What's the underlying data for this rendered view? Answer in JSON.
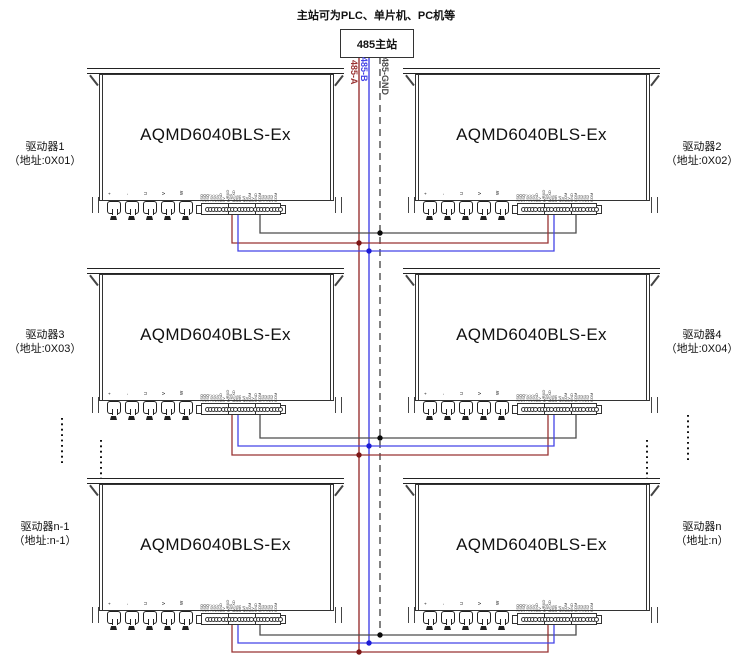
{
  "header": {
    "note": "主站可为PLC、单片机、PC机等"
  },
  "master": {
    "label": "485主站"
  },
  "bus": {
    "lines": [
      {
        "id": "485-A",
        "label": "485-A",
        "color": "#993333",
        "style": "solid"
      },
      {
        "id": "485-B",
        "label": "485-B",
        "color": "#4444e6",
        "style": "solid"
      },
      {
        "id": "485-GND",
        "label": "485-GND",
        "color": "#4c4c4c",
        "style": "dashed"
      }
    ]
  },
  "driver_model": "AQMD6040BLS-Ex",
  "drivers": [
    {
      "name": "驱动器1",
      "addr": "（地址:0X01）",
      "side": "left"
    },
    {
      "name": "驱动器2",
      "addr": "（地址:0X02）",
      "side": "right"
    },
    {
      "name": "驱动器3",
      "addr": "（地址:0X03）",
      "side": "left"
    },
    {
      "name": "驱动器4",
      "addr": "（地址:0X04）",
      "side": "right"
    },
    {
      "name": "驱动器n-1",
      "addr": "（地址:n-1）",
      "side": "left"
    },
    {
      "name": "驱动器n",
      "addr": "（地址:n）",
      "side": "right"
    }
  ],
  "terminals": {
    "power_labels": [
      "+",
      "-",
      "U",
      "V",
      "W"
    ],
    "pin_labels": [
      "1SQ",
      "2SQ",
      "3SQ",
      "1SV",
      "2SV",
      "3SV",
      "GND",
      "5V",
      "A/RXD",
      "TDS",
      "B/TXD",
      "DIS",
      "DIR",
      "AVI",
      "SV",
      "COM",
      "5V",
      "GND",
      "COM",
      "1S1",
      "1S2",
      "2S1",
      "2S2",
      "COM"
    ],
    "rs485_connection": {
      "a_pin": "A/RXD",
      "b_pin": "B/TXD",
      "gnd_pin": "GND"
    }
  },
  "colors": {
    "wire_a": "#993333",
    "wire_b": "#4444e6",
    "wire_gnd": "#4c4c4c",
    "junction_a": "#7d1616",
    "junction_b": "#1d1dd6",
    "junction_gnd": "#0a0a0a",
    "outline": "#333333"
  }
}
